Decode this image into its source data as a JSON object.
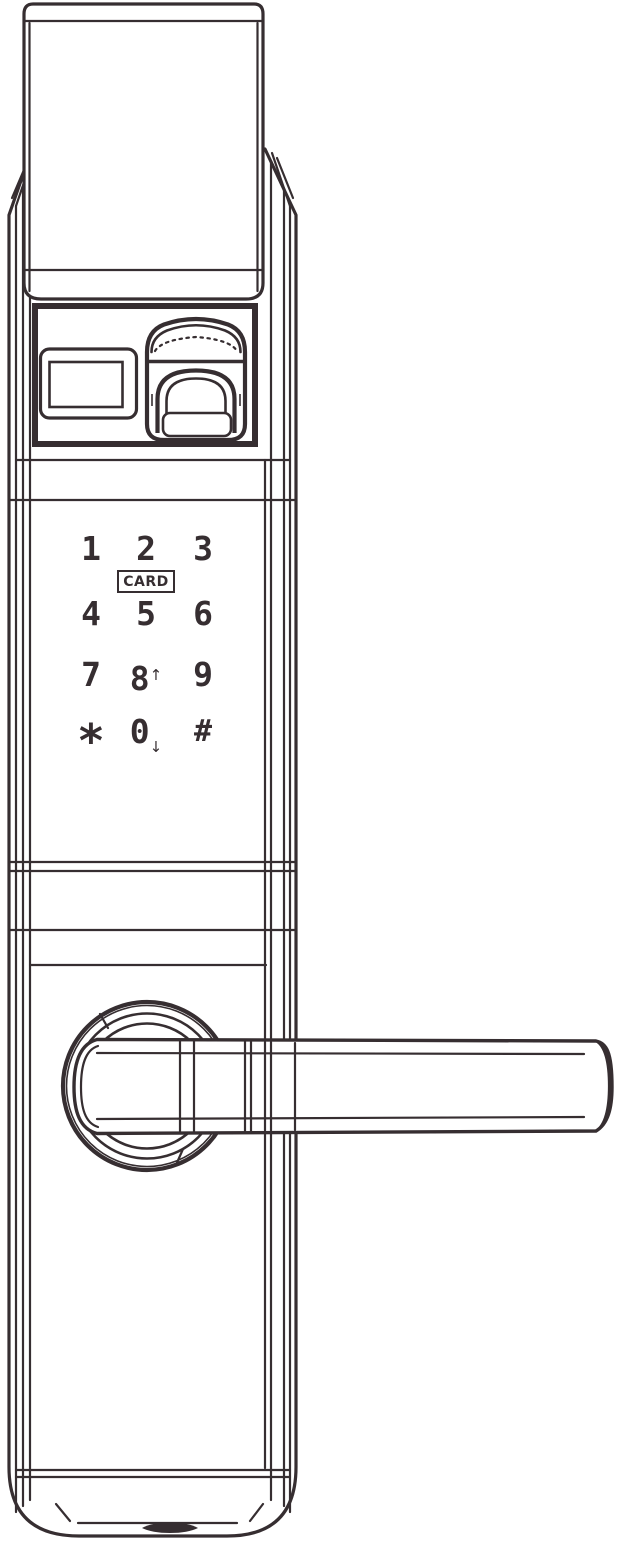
{
  "device": {
    "type": "smart-door-lock-front-view-line-drawing"
  },
  "colors": {
    "line": "#362e31",
    "background": "#ffffff"
  },
  "keypad": {
    "card_label": "CARD",
    "keys": [
      {
        "label": "1"
      },
      {
        "label": "2"
      },
      {
        "label": "3"
      },
      {
        "label": "4"
      },
      {
        "label": "5"
      },
      {
        "label": "6"
      },
      {
        "label": "7"
      },
      {
        "label": "8",
        "arrow": "↑"
      },
      {
        "label": "9"
      },
      {
        "label": "*"
      },
      {
        "label": "0",
        "arrow": "↓"
      },
      {
        "label": "#"
      }
    ]
  }
}
